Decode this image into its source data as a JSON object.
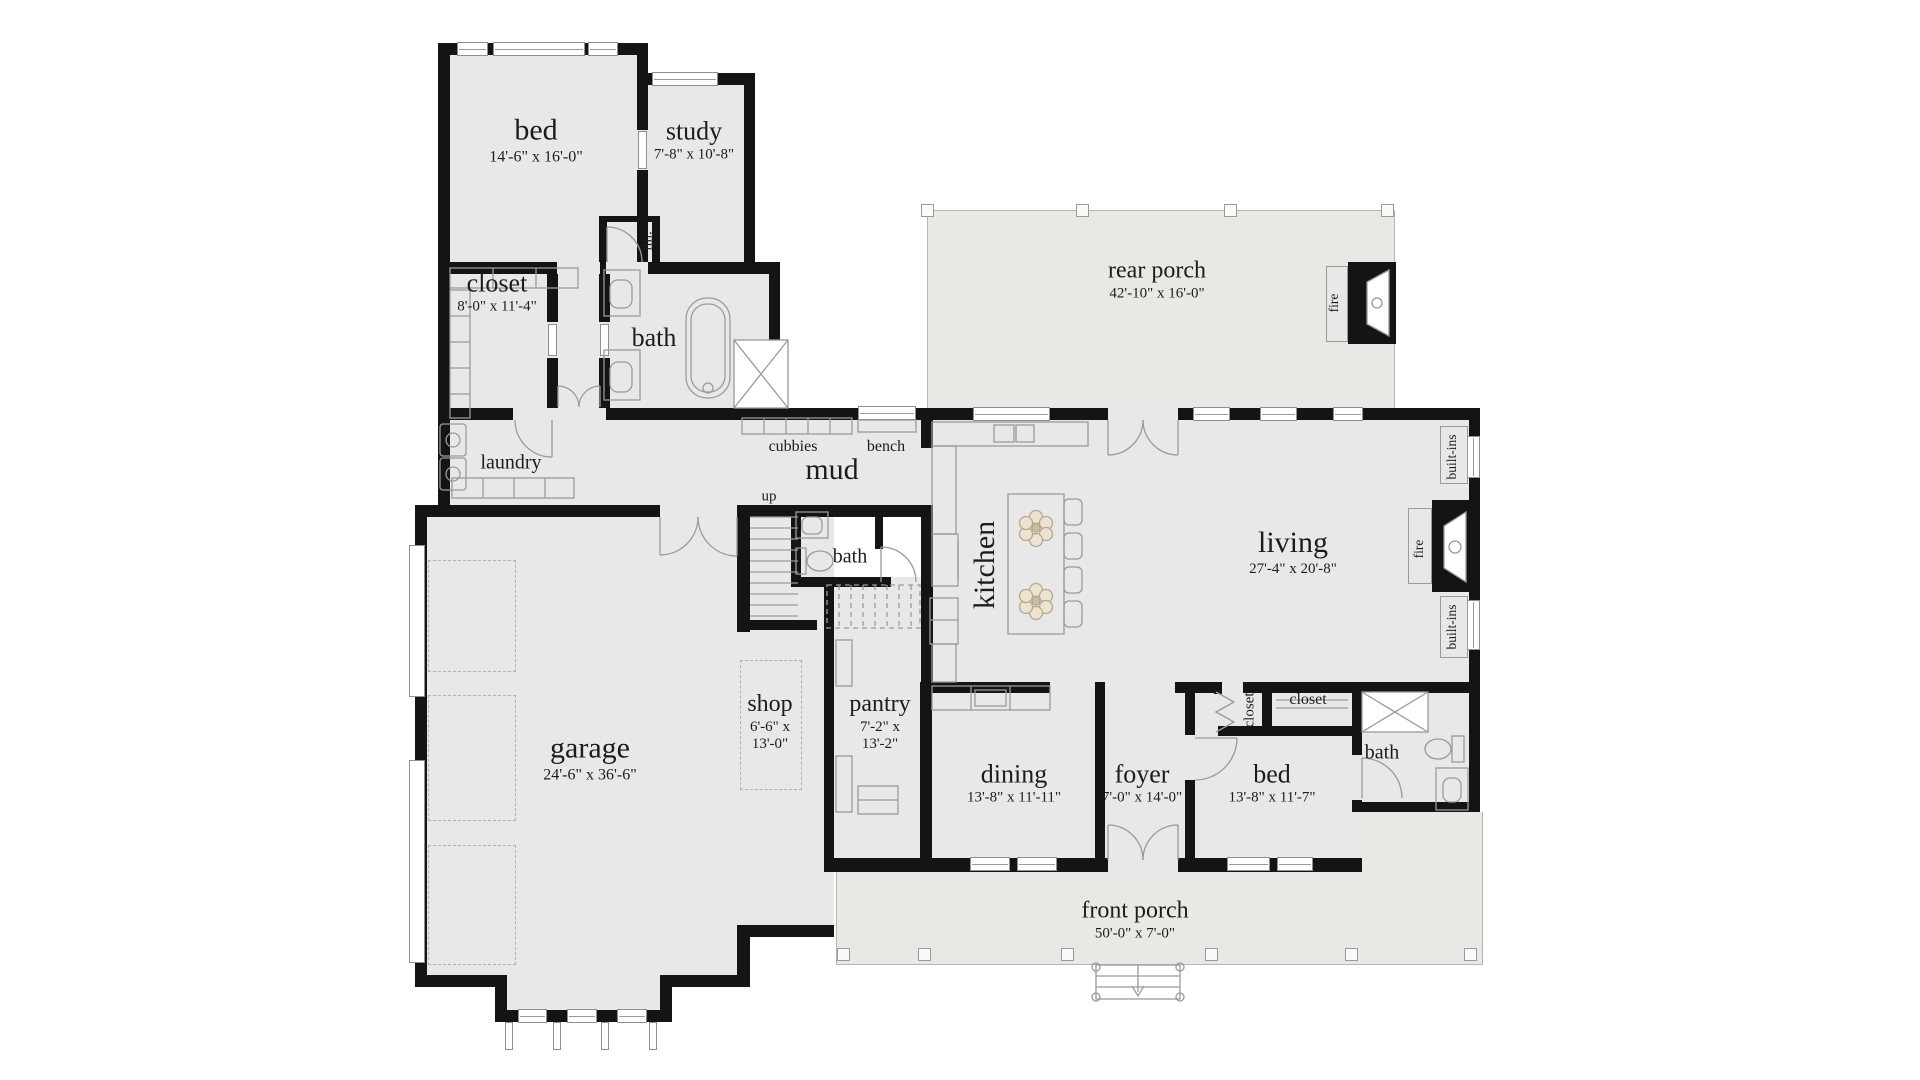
{
  "rooms": {
    "bed1": {
      "name": "bed",
      "dims": "14'-6\" x 16'-0\""
    },
    "study": {
      "name": "study",
      "dims": "7'-8\" x 10'-8\""
    },
    "closet1": {
      "name": "closet",
      "dims": "8'-0\" x 11'-4\""
    },
    "lin": {
      "name": "lin."
    },
    "bath1": {
      "name": "bath"
    },
    "laundry": {
      "name": "laundry"
    },
    "mud": {
      "name": "mud"
    },
    "cubbies": {
      "name": "cubbies"
    },
    "bench": {
      "name": "bench"
    },
    "up": {
      "name": "up"
    },
    "bath2": {
      "name": "bath"
    },
    "kitchen": {
      "name": "kitchen"
    },
    "living": {
      "name": "living",
      "dims": "27'-4\" x 20'-8\""
    },
    "rear_porch": {
      "name": "rear porch",
      "dims": "42'-10\" x 16'-0\""
    },
    "fire_porch": {
      "name": "fire"
    },
    "fire_living": {
      "name": "fire"
    },
    "builtins_top": {
      "name": "built-ins"
    },
    "builtins_bot": {
      "name": "built-ins"
    },
    "garage": {
      "name": "garage",
      "dims": "24'-6\" x 36'-6\""
    },
    "shop": {
      "name": "shop",
      "dims1": "6'-6\" x",
      "dims2": "13'-0\""
    },
    "pantry": {
      "name": "pantry",
      "dims1": "7'-2\" x",
      "dims2": "13'-2\""
    },
    "dining": {
      "name": "dining",
      "dims": "13'-8\" x 11'-11\""
    },
    "foyer": {
      "name": "foyer",
      "dims": "7'-0\" x 14'-0\""
    },
    "bed2": {
      "name": "bed",
      "dims": "13'-8\" x 11'-7\""
    },
    "closet2": {
      "name": "closet"
    },
    "closet3": {
      "name": "closet"
    },
    "bath3": {
      "name": "bath"
    },
    "front_porch": {
      "name": "front porch",
      "dims": "50'-0\" x 7'-0\""
    }
  },
  "colors": {
    "wall": "#141414",
    "room_fill": "#e8e8e8",
    "porch_fill": "#e9e8e4",
    "fixture_line": "#9a9a9a",
    "pendant_fill": "#ece4cf"
  }
}
